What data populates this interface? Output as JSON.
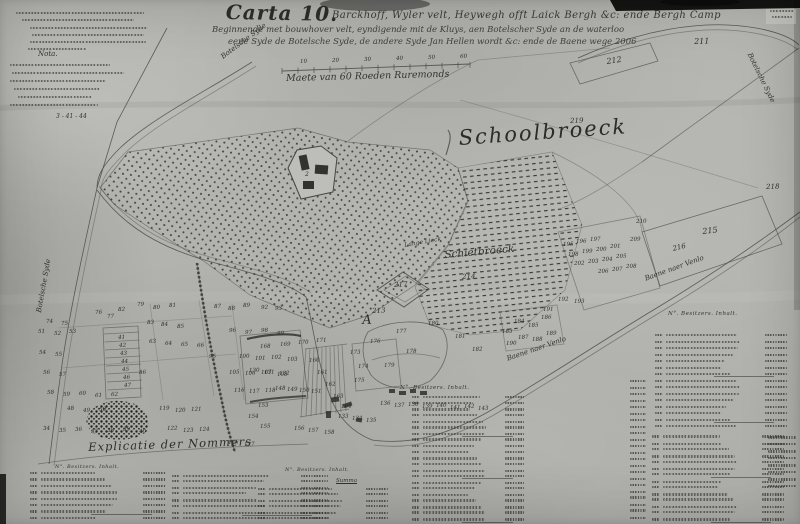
{
  "title": {
    "carta": "Carta 10.",
    "line1": "Barckhoff, Wyler velt, Heywegh offt Laick Bergh &c: ende Bergh Camp",
    "line2": "Beginnende met bouwhover velt, eyndigende mit de Kluys, aen Botelscher Syde an de waterloo",
    "line3": "eene Syde de Botelsche Syde, de andere Syde Jan Hellen wordt &c: ende de Baene wege 2006"
  },
  "notes": {
    "nota": "Nota.",
    "fragment": "3 - 41 - 44"
  },
  "scale": {
    "label": "Maete van 60 Roeden Ruremonds"
  },
  "regions": {
    "schoolbroeck": "Schoolbroeck",
    "schietbroeck": "Schietbroeck"
  },
  "roads": {
    "botelsche": "Botelsche Syde",
    "venlo": "Baene naer Venlo",
    "lange": "Lange Lieck"
  },
  "legend": {
    "heading": "Explicatie der Nommers",
    "columns": "N°.   Besitzers.   Inhalt.",
    "summa": "Summa"
  },
  "map": {
    "parcel_labels": [
      {
        "t": "211",
        "x": 694,
        "y": 38,
        "s": 8
      },
      {
        "t": "212",
        "x": 606,
        "y": 58,
        "s": 8,
        "r": -8
      },
      {
        "t": "219",
        "x": 570,
        "y": 118,
        "s": 7
      },
      {
        "t": "218",
        "x": 766,
        "y": 184,
        "s": 7
      },
      {
        "t": "215",
        "x": 702,
        "y": 228,
        "s": 8,
        "r": -6
      },
      {
        "t": "216",
        "x": 672,
        "y": 246,
        "s": 7,
        "r": -14
      },
      {
        "t": "217",
        "x": 394,
        "y": 282,
        "s": 7
      },
      {
        "t": "213",
        "x": 372,
        "y": 308,
        "s": 7
      },
      {
        "t": "214",
        "x": 462,
        "y": 274,
        "s": 7
      },
      {
        "t": "A",
        "x": 362,
        "y": 314,
        "s": 13
      },
      {
        "t": "2",
        "x": 305,
        "y": 172,
        "s": 6
      }
    ],
    "small_numbers": [
      [
        "79",
        137,
        303
      ],
      [
        "80",
        153,
        306
      ],
      [
        "81",
        169,
        304
      ],
      [
        "82",
        118,
        308
      ],
      [
        "87",
        214,
        305
      ],
      [
        "88",
        228,
        307
      ],
      [
        "89",
        243,
        304
      ],
      [
        "92",
        261,
        306
      ],
      [
        "93",
        275,
        307
      ],
      [
        "76",
        95,
        311
      ],
      [
        "77",
        107,
        315
      ],
      [
        "74",
        46,
        320
      ],
      [
        "75",
        61,
        322
      ],
      [
        "51",
        38,
        330
      ],
      [
        "52",
        54,
        332
      ],
      [
        "53",
        69,
        330
      ],
      [
        "83",
        147,
        321
      ],
      [
        "84",
        161,
        323
      ],
      [
        "85",
        177,
        325
      ],
      [
        "96",
        229,
        329
      ],
      [
        "97",
        245,
        331
      ],
      [
        "98",
        261,
        329
      ],
      [
        "99",
        277,
        332
      ],
      [
        "63",
        149,
        340
      ],
      [
        "64",
        165,
        342
      ],
      [
        "65",
        181,
        343
      ],
      [
        "66",
        197,
        344
      ],
      [
        "54",
        39,
        351
      ],
      [
        "55",
        55,
        353
      ],
      [
        "95",
        209,
        355
      ],
      [
        "100",
        239,
        355
      ],
      [
        "101",
        255,
        357
      ],
      [
        "102",
        271,
        356
      ],
      [
        "103",
        287,
        358
      ],
      [
        "41",
        118,
        336
      ],
      [
        "42",
        119,
        344
      ],
      [
        "43",
        120,
        352
      ],
      [
        "44",
        121,
        360
      ],
      [
        "45",
        122,
        368
      ],
      [
        "46",
        123,
        376
      ],
      [
        "47",
        124,
        384
      ],
      [
        "56",
        43,
        371
      ],
      [
        "57",
        59,
        373
      ],
      [
        "86",
        139,
        371
      ],
      [
        "105",
        229,
        371
      ],
      [
        "106",
        245,
        372
      ],
      [
        "107",
        261,
        371
      ],
      [
        "108",
        277,
        373
      ],
      [
        "58",
        47,
        391
      ],
      [
        "59",
        63,
        393
      ],
      [
        "60",
        79,
        392
      ],
      [
        "61",
        95,
        394
      ],
      [
        "62",
        111,
        393
      ],
      [
        "116",
        234,
        389
      ],
      [
        "117",
        249,
        390
      ],
      [
        "118",
        265,
        389
      ],
      [
        "48",
        67,
        407
      ],
      [
        "49",
        83,
        409
      ],
      [
        "50",
        99,
        408
      ],
      [
        "119",
        159,
        407
      ],
      [
        "120",
        175,
        409
      ],
      [
        "121",
        191,
        408
      ],
      [
        "34",
        43,
        427
      ],
      [
        "35",
        59,
        429
      ],
      [
        "36",
        75,
        428
      ],
      [
        "37",
        91,
        430
      ],
      [
        "38",
        107,
        429
      ],
      [
        "39",
        123,
        428
      ],
      [
        "40",
        139,
        430
      ],
      [
        "122",
        167,
        427
      ],
      [
        "123",
        183,
        429
      ],
      [
        "124",
        199,
        428
      ],
      [
        "168",
        260,
        345
      ],
      [
        "169",
        280,
        343
      ],
      [
        "170",
        298,
        341
      ],
      [
        "171",
        316,
        339
      ],
      [
        "130",
        249,
        369
      ],
      [
        "131",
        264,
        371
      ],
      [
        "132",
        279,
        372
      ],
      [
        "148",
        275,
        387
      ],
      [
        "149",
        287,
        388
      ],
      [
        "150",
        299,
        389
      ],
      [
        "151",
        311,
        390
      ],
      [
        "153",
        258,
        404
      ],
      [
        "154",
        248,
        415
      ],
      [
        "155",
        260,
        425
      ],
      [
        "156",
        294,
        427
      ],
      [
        "157",
        308,
        429
      ],
      [
        "158",
        324,
        431
      ],
      [
        "160",
        309,
        359
      ],
      [
        "161",
        317,
        371
      ],
      [
        "162",
        325,
        383
      ],
      [
        "163",
        333,
        395
      ],
      [
        "164",
        341,
        405
      ],
      [
        "126",
        228,
        441
      ],
      [
        "127",
        244,
        443
      ],
      [
        "133",
        338,
        415
      ],
      [
        "134",
        352,
        417
      ],
      [
        "135",
        366,
        419
      ],
      [
        "136",
        380,
        402
      ],
      [
        "137",
        394,
        404
      ],
      [
        "138",
        408,
        403
      ],
      [
        "139",
        422,
        405
      ],
      [
        "140",
        436,
        404
      ],
      [
        "141",
        450,
        406
      ],
      [
        "142",
        464,
        405
      ],
      [
        "143",
        478,
        407
      ],
      [
        "173",
        350,
        351
      ],
      [
        "174",
        358,
        365
      ],
      [
        "175",
        354,
        379
      ],
      [
        "176",
        370,
        340
      ],
      [
        "177",
        396,
        330
      ],
      [
        "178",
        406,
        350
      ],
      [
        "179",
        384,
        364
      ],
      [
        "180",
        428,
        322
      ],
      [
        "181",
        455,
        335
      ],
      [
        "182",
        472,
        348
      ],
      [
        "183",
        502,
        330
      ],
      [
        "184",
        514,
        320
      ],
      [
        "185",
        528,
        324
      ],
      [
        "186",
        541,
        316
      ],
      [
        "187",
        518,
        336
      ],
      [
        "188",
        532,
        338
      ],
      [
        "189",
        546,
        332
      ],
      [
        "190",
        506,
        342
      ],
      [
        "191",
        543,
        308
      ],
      [
        "192",
        558,
        298
      ],
      [
        "193",
        574,
        300
      ],
      [
        "195",
        563,
        243
      ],
      [
        "196",
        576,
        240
      ],
      [
        "197",
        590,
        238
      ],
      [
        "198",
        568,
        253
      ],
      [
        "199",
        582,
        250
      ],
      [
        "200",
        596,
        248
      ],
      [
        "201",
        610,
        245
      ],
      [
        "202",
        574,
        262
      ],
      [
        "203",
        588,
        260
      ],
      [
        "204",
        602,
        258
      ],
      [
        "205",
        616,
        255
      ],
      [
        "206",
        598,
        270
      ],
      [
        "207",
        612,
        268
      ],
      [
        "208",
        626,
        265
      ],
      [
        "209",
        630,
        238
      ],
      [
        "210",
        636,
        220
      ],
      [
        "10",
        300,
        60
      ],
      [
        "20",
        332,
        59
      ],
      [
        "30",
        364,
        58
      ],
      [
        "40",
        396,
        57
      ],
      [
        "50",
        428,
        56
      ],
      [
        "60",
        460,
        55
      ]
    ],
    "table_blocks": [
      {
        "x": 30,
        "y": 472,
        "w": 136,
        "n": 8,
        "p": 6.4
      },
      {
        "x": 172,
        "y": 474,
        "w": 156,
        "n": 8,
        "p": 6.2
      },
      {
        "x": 258,
        "y": 487,
        "w": 130,
        "n": 6,
        "p": 6.1
      },
      {
        "x": 412,
        "y": 396,
        "w": 112,
        "n": 21,
        "p": 6.1
      },
      {
        "x": 655,
        "y": 334,
        "w": 132,
        "n": 15,
        "p": 6.5
      },
      {
        "x": 652,
        "y": 436,
        "w": 132,
        "n": 14,
        "p": 6.3
      },
      {
        "x": 630,
        "y": 380,
        "w": 16,
        "n": 22,
        "p": 6.5
      },
      {
        "x": 768,
        "y": 436,
        "w": 28,
        "n": 8,
        "p": 7.0
      }
    ],
    "note_lines": [
      [
        16,
        12,
        128
      ],
      [
        22,
        19,
        112
      ],
      [
        30,
        27,
        118
      ],
      [
        32,
        34,
        112
      ],
      [
        30,
        41,
        116
      ],
      [
        28,
        48,
        58
      ],
      [
        10,
        64,
        100
      ],
      [
        12,
        72,
        112
      ],
      [
        10,
        80,
        96
      ],
      [
        14,
        88,
        86
      ],
      [
        18,
        96,
        74
      ],
      [
        10,
        104,
        88
      ],
      [
        770,
        10,
        24
      ],
      [
        772,
        16,
        20
      ]
    ],
    "ink_color": "#45453f",
    "paper_color": "#b2b2ae"
  }
}
